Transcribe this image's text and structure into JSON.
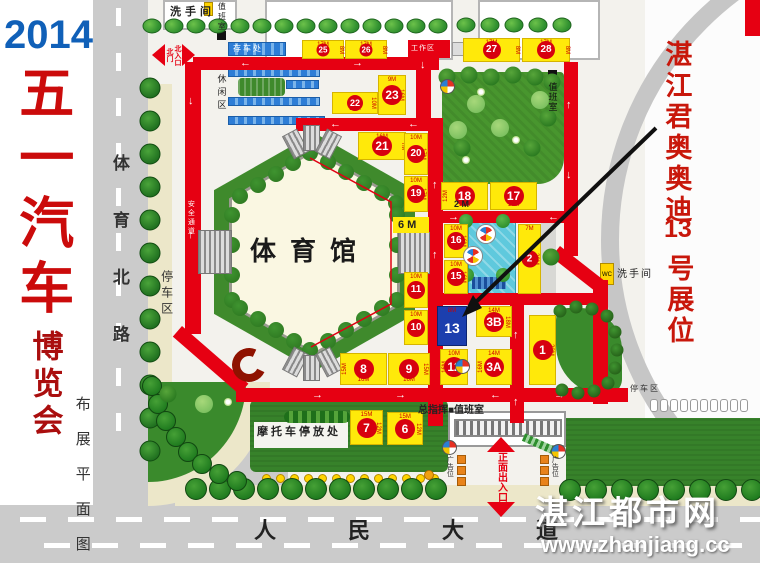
{
  "title": {
    "year": "2014",
    "main": "五一汽车",
    "sub": "博览会",
    "plan": "布展平面图"
  },
  "roads": {
    "west": "体育北路",
    "south": "人民大道"
  },
  "labels": {
    "stadium": "体育馆",
    "restroom_nw": "洗手间",
    "duty_nw": "值班室",
    "bike": "存车处",
    "leisure": "休闲区",
    "work": "工作区",
    "safety": "安全通道",
    "parking_w": "停车区",
    "gate_n1": "北门",
    "gate_n2": "北入口",
    "six_m": "6 M",
    "two_m": "2 M",
    "duty_ne": "值班室",
    "restroom_e": "洗手间",
    "wc": "WC",
    "command": "总指挥■值班室",
    "moto": "摩托车停放处",
    "gate_main": "正面出入口",
    "ad_l": "广告位",
    "ad_r": "广告位",
    "parking_e": "停车区"
  },
  "note": {
    "line1": "湛江君奥奥迪",
    "line2": "13",
    "line3": "号展位"
  },
  "watermark": {
    "name": "湛江都市网",
    "url": "www.zhanjiang.cc"
  },
  "colors": {
    "route_red": "#e60012",
    "booth_yellow": "#ffe90a",
    "circle_red": "#d7000f",
    "booth13_blue": "#1c3fae",
    "lawn_green": "#37822a",
    "road_gray": "#cbcbcb"
  },
  "map": {
    "booths": [
      {
        "no": "25",
        "x": 302,
        "y": 40,
        "w": 42,
        "h": 19,
        "t": "17M",
        "r": "8M"
      },
      {
        "no": "26",
        "x": 345,
        "y": 40,
        "w": 42,
        "h": 19,
        "t": "17M",
        "r": "8M"
      },
      {
        "no": "27",
        "x": 463,
        "y": 38,
        "w": 57,
        "h": 24,
        "t": "17M",
        "r": "8M"
      },
      {
        "no": "28",
        "x": 522,
        "y": 38,
        "w": 48,
        "h": 24,
        "t": "17M",
        "r": "8M"
      },
      {
        "no": "22",
        "x": 332,
        "y": 92,
        "w": 46,
        "h": 22,
        "b": "17M",
        "r": "10M"
      },
      {
        "no": "23",
        "x": 378,
        "y": 75,
        "w": 28,
        "h": 40,
        "t": "9M",
        "r": "16M"
      },
      {
        "no": "21",
        "x": 358,
        "y": 132,
        "w": 48,
        "h": 28,
        "t": "16M",
        "r": "7M"
      },
      {
        "no": "20",
        "x": 404,
        "y": 133,
        "w": 24,
        "h": 42,
        "t": "10M",
        "r": "17M"
      },
      {
        "no": "19",
        "x": 404,
        "y": 176,
        "w": 24,
        "h": 36,
        "t": "10M",
        "r": "17M"
      },
      {
        "no": "18",
        "x": 441,
        "y": 182,
        "w": 47,
        "h": 28,
        "b": "17M",
        "l": "12M"
      },
      {
        "no": "17",
        "x": 490,
        "y": 182,
        "w": 47,
        "h": 28,
        "b": "17M"
      },
      {
        "no": "16",
        "x": 444,
        "y": 224,
        "w": 24,
        "h": 34,
        "t": "10M",
        "r": "16M"
      },
      {
        "no": "15",
        "x": 444,
        "y": 260,
        "w": 24,
        "h": 34,
        "t": "10M",
        "r": "16M"
      },
      {
        "no": "2",
        "x": 518,
        "y": 224,
        "w": 23,
        "h": 70,
        "t": "7M",
        "r": "20M"
      },
      {
        "no": "13",
        "x": 437,
        "y": 306,
        "w": 30,
        "h": 40,
        "t": "8M",
        "blue": true
      },
      {
        "no": "3B",
        "x": 476,
        "y": 306,
        "w": 36,
        "h": 31,
        "t": "14M",
        "r": "18M"
      },
      {
        "no": "3A",
        "x": 476,
        "y": 349,
        "w": 36,
        "h": 36,
        "t": "14M",
        "l": "16M"
      },
      {
        "no": "12",
        "x": 440,
        "y": 349,
        "w": 28,
        "h": 36,
        "t": "10M",
        "l": "16M"
      },
      {
        "no": "1",
        "x": 529,
        "y": 315,
        "w": 27,
        "h": 70,
        "r": "23M"
      },
      {
        "no": "11",
        "x": 404,
        "y": 272,
        "w": 24,
        "h": 36,
        "t": "10M"
      },
      {
        "no": "10",
        "x": 404,
        "y": 310,
        "w": 24,
        "h": 35,
        "t": "10M"
      },
      {
        "no": "8",
        "x": 340,
        "y": 353,
        "w": 47,
        "h": 32,
        "l": "15M",
        "b": "16M"
      },
      {
        "no": "9",
        "x": 388,
        "y": 353,
        "w": 42,
        "h": 32,
        "r": "15M",
        "b": "16M"
      },
      {
        "no": "7",
        "x": 350,
        "y": 410,
        "w": 33,
        "h": 35,
        "t": "15M",
        "r": "12M"
      },
      {
        "no": "6",
        "x": 387,
        "y": 412,
        "w": 36,
        "h": 33,
        "t": "15M",
        "r": "12M"
      }
    ],
    "routes": [
      [
        193,
        57,
        246,
        13
      ],
      [
        185,
        62,
        16,
        272
      ],
      [
        182,
        326,
        88,
        14,
        41
      ],
      [
        236,
        388,
        392,
        14
      ],
      [
        416,
        57,
        15,
        72
      ],
      [
        296,
        118,
        146,
        13
      ],
      [
        428,
        118,
        15,
        308
      ],
      [
        430,
        211,
        148,
        12
      ],
      [
        564,
        62,
        14,
        194
      ],
      [
        560,
        246,
        56,
        14,
        38
      ],
      [
        593,
        280,
        15,
        124
      ],
      [
        430,
        293,
        178,
        12
      ],
      [
        510,
        293,
        14,
        130
      ]
    ],
    "route_arrows": [
      [
        240,
        58,
        "←"
      ],
      [
        352,
        58,
        "→"
      ],
      [
        420,
        60,
        "↓"
      ],
      [
        188,
        96,
        "↓"
      ],
      [
        188,
        230,
        "↑"
      ],
      [
        330,
        119,
        "←"
      ],
      [
        408,
        119,
        "←"
      ],
      [
        448,
        212,
        "→"
      ],
      [
        548,
        212,
        "←"
      ],
      [
        566,
        100,
        "↑"
      ],
      [
        566,
        170,
        "↓"
      ],
      [
        432,
        180,
        "↑"
      ],
      [
        432,
        250,
        "↑"
      ],
      [
        312,
        390,
        "→"
      ],
      [
        395,
        390,
        "→"
      ],
      [
        490,
        390,
        "←"
      ],
      [
        554,
        390,
        "→"
      ],
      [
        595,
        384,
        "↑"
      ],
      [
        513,
        330,
        "↑"
      ],
      [
        513,
        397,
        "↑"
      ]
    ],
    "stairs": [
      [
        198,
        230,
        34,
        44,
        0
      ],
      [
        398,
        232,
        32,
        42,
        0
      ],
      [
        287,
        131,
        17,
        26,
        -28
      ],
      [
        303,
        125,
        17,
        26,
        0
      ],
      [
        320,
        131,
        17,
        26,
        28
      ],
      [
        287,
        349,
        17,
        26,
        28
      ],
      [
        303,
        355,
        17,
        26,
        0
      ],
      [
        320,
        349,
        17,
        26,
        -28
      ]
    ],
    "bands": [
      [
        228,
        42,
        58,
        14
      ],
      [
        228,
        68,
        92,
        9
      ],
      [
        286,
        80,
        33,
        9
      ],
      [
        228,
        97,
        92,
        9
      ],
      [
        228,
        116,
        97,
        9
      ]
    ],
    "dots": {
      "x": 262,
      "y": 474,
      "step": 14,
      "count": 13
    },
    "picons": {
      "x": 650,
      "y": 399,
      "step": 10,
      "count": 10
    },
    "dashes": {
      "west": [
        8,
        53,
        98,
        143,
        188,
        233,
        278,
        323,
        368,
        413
      ],
      "south": [
        [
          20,
          517
        ],
        [
          68,
          517
        ],
        [
          116,
          517
        ],
        [
          164,
          517
        ],
        [
          212,
          517
        ],
        [
          260,
          517
        ],
        [
          308,
          517
        ],
        [
          356,
          517
        ],
        [
          404,
          517
        ],
        [
          452,
          517
        ],
        [
          500,
          517
        ],
        [
          548,
          517
        ],
        [
          596,
          517
        ],
        [
          644,
          517
        ],
        [
          692,
          517
        ],
        [
          740,
          517
        ],
        [
          44,
          543
        ],
        [
          92,
          543
        ],
        [
          140,
          543
        ],
        [
          188,
          543
        ],
        [
          236,
          543
        ],
        [
          284,
          543
        ],
        [
          332,
          543
        ],
        [
          380,
          543
        ],
        [
          428,
          543
        ],
        [
          476,
          543
        ],
        [
          524,
          543
        ],
        [
          572,
          543
        ],
        [
          620,
          543
        ],
        [
          668,
          543
        ],
        [
          716,
          543
        ]
      ]
    },
    "trees": {
      "t-top": [
        [
          152,
          26
        ],
        [
          174,
          26
        ],
        [
          196,
          26
        ],
        [
          218,
          26
        ],
        [
          240,
          26
        ],
        [
          262,
          26
        ],
        [
          284,
          26
        ],
        [
          306,
          26
        ],
        [
          328,
          26
        ],
        [
          350,
          26
        ],
        [
          372,
          26
        ],
        [
          394,
          26
        ],
        [
          416,
          26
        ],
        [
          438,
          26
        ],
        [
          466,
          25
        ],
        [
          490,
          25
        ],
        [
          514,
          25
        ],
        [
          538,
          25
        ],
        [
          562,
          25
        ]
      ],
      "t-west": [
        [
          150,
          88
        ],
        [
          150,
          121
        ],
        [
          150,
          154
        ],
        [
          150,
          187
        ],
        [
          150,
          220
        ],
        [
          150,
          253
        ],
        [
          150,
          286
        ],
        [
          150,
          319
        ],
        [
          150,
          352
        ],
        [
          150,
          385
        ],
        [
          150,
          418
        ],
        [
          150,
          451
        ]
      ],
      "t-south": [
        [
          196,
          489
        ],
        [
          220,
          489
        ],
        [
          244,
          489
        ],
        [
          268,
          489
        ],
        [
          292,
          489
        ],
        [
          316,
          489
        ],
        [
          340,
          489
        ],
        [
          364,
          489
        ],
        [
          388,
          489
        ],
        [
          412,
          489
        ],
        [
          436,
          489
        ],
        [
          570,
          490
        ],
        [
          596,
          490
        ],
        [
          622,
          490
        ],
        [
          648,
          490
        ],
        [
          674,
          490
        ],
        [
          700,
          490
        ],
        [
          726,
          490
        ],
        [
          752,
          490
        ]
      ],
      "t-corner": [
        [
          152,
          386
        ],
        [
          158,
          404
        ],
        [
          166,
          421
        ],
        [
          176,
          437
        ],
        [
          188,
          452
        ],
        [
          202,
          464
        ],
        [
          219,
          474
        ],
        [
          237,
          481
        ]
      ],
      "t-pool": [
        [
          466,
          221
        ],
        [
          503,
          221
        ],
        [
          467,
          275
        ],
        [
          503,
          275
        ]
      ],
      "t-park": [
        [
          447,
          77
        ],
        [
          469,
          75
        ],
        [
          491,
          77
        ],
        [
          513,
          75
        ],
        [
          535,
          77
        ],
        [
          552,
          82
        ],
        [
          548,
          118
        ],
        [
          532,
          148
        ],
        [
          462,
          148
        ],
        [
          551,
          257
        ],
        [
          168,
          394
        ]
      ],
      "t-parklight": [
        [
          476,
          104
        ],
        [
          500,
          128
        ],
        [
          458,
          130
        ],
        [
          540,
          100
        ],
        [
          204,
          404
        ]
      ],
      "t-flower": [
        [
          481,
          92
        ],
        [
          516,
          140
        ],
        [
          466,
          160
        ],
        [
          228,
          402
        ]
      ],
      "t-blob": [
        [
          560,
          311
        ],
        [
          576,
          307
        ],
        [
          592,
          309
        ],
        [
          607,
          316
        ],
        [
          615,
          332
        ],
        [
          617,
          350
        ],
        [
          615,
          368
        ],
        [
          608,
          383
        ],
        [
          594,
          391
        ],
        [
          578,
          393
        ],
        [
          562,
          390
        ]
      ],
      "t-bump": [
        [
          240,
          196
        ],
        [
          258,
          185
        ],
        [
          276,
          174
        ],
        [
          293,
          163
        ],
        [
          310,
          153
        ],
        [
          328,
          162
        ],
        [
          346,
          172
        ],
        [
          364,
          183
        ],
        [
          382,
          193
        ],
        [
          396,
          203
        ],
        [
          232,
          215
        ],
        [
          232,
          245
        ],
        [
          232,
          275
        ],
        [
          232,
          300
        ],
        [
          397,
          215
        ],
        [
          397,
          245
        ],
        [
          397,
          275
        ],
        [
          397,
          300
        ],
        [
          240,
          308
        ],
        [
          258,
          319
        ],
        [
          276,
          330
        ],
        [
          294,
          341
        ],
        [
          310,
          350
        ],
        [
          328,
          341
        ],
        [
          346,
          330
        ],
        [
          364,
          319
        ],
        [
          382,
          308
        ]
      ]
    }
  }
}
